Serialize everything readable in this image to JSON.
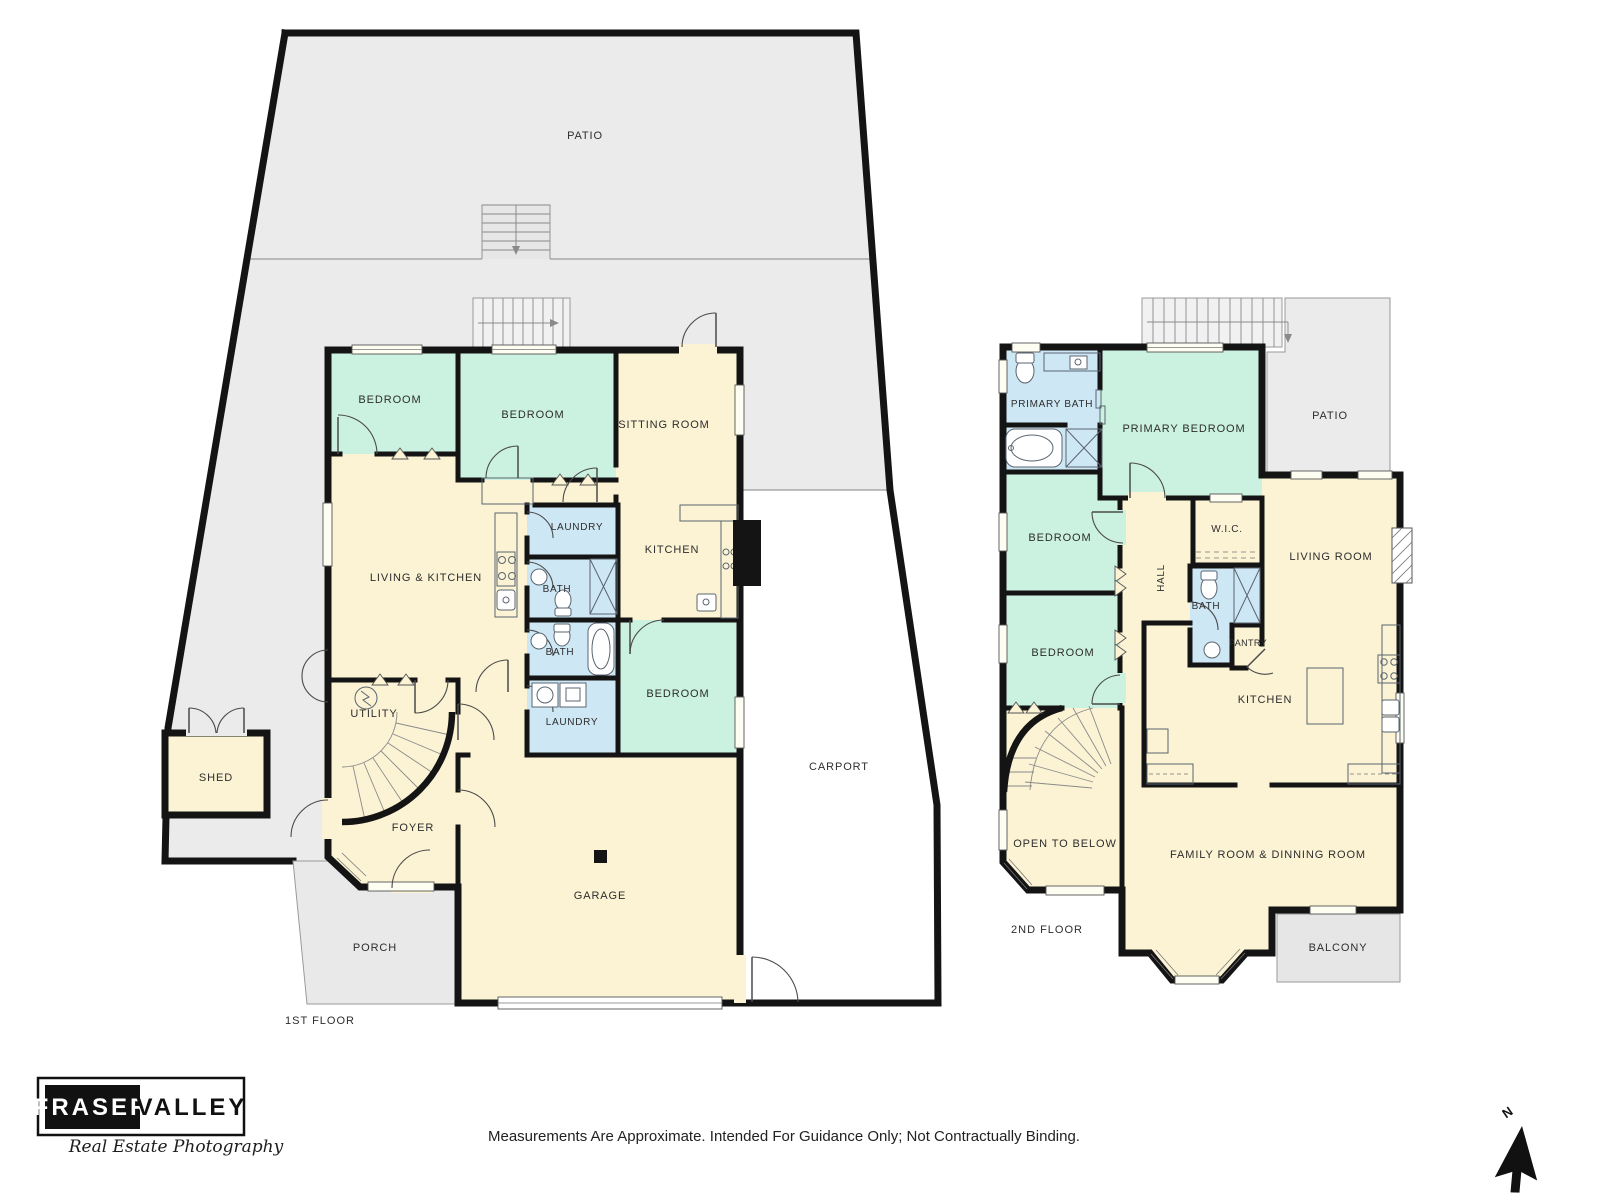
{
  "labels": {
    "patio": "PATIO",
    "bedroom": "BEDROOM",
    "sitting_room": "SITTING ROOM",
    "living_kitchen": "LIVING & KITCHEN",
    "laundry": "LAUNDRY",
    "bath": "BATH",
    "kitchen": "KITCHEN",
    "utility": "UTILITY",
    "shed": "SHED",
    "foyer": "FOYER",
    "garage": "GARAGE",
    "porch": "PORCH",
    "carport": "CARPORT",
    "primary_bath": "PRIMARY BATH",
    "primary_bedroom": "PRIMARY BEDROOM",
    "wic": "W.I.C.",
    "living_room": "LIVING ROOM",
    "hall": "HALL",
    "pantry": "PANTRY",
    "open_to_below": "OPEN TO BELOW",
    "family_dining": "FAMILY ROOM & DINNING ROOM",
    "balcony": "BALCONY",
    "floor1_caption": "1ST FLOOR",
    "floor2_caption": "2ND FLOOR"
  },
  "footer": {
    "brand_left": "FRASER",
    "brand_right": "VALLEY",
    "brand_tagline": "Real Estate Photography",
    "disclaimer": "Measurements Are Approximate. Intended For Guidance Only; Not Contractually Binding.",
    "north_label": "N"
  },
  "colors": {
    "cream": "#FBF3D4",
    "mint": "#CBF1E0",
    "blue": "#CEE7F4",
    "site": "#EBEBEB",
    "porch": "#E9E9E9",
    "stair": "#F1F1F1",
    "balcony": "#E6E6E6",
    "wall": "#141414"
  }
}
